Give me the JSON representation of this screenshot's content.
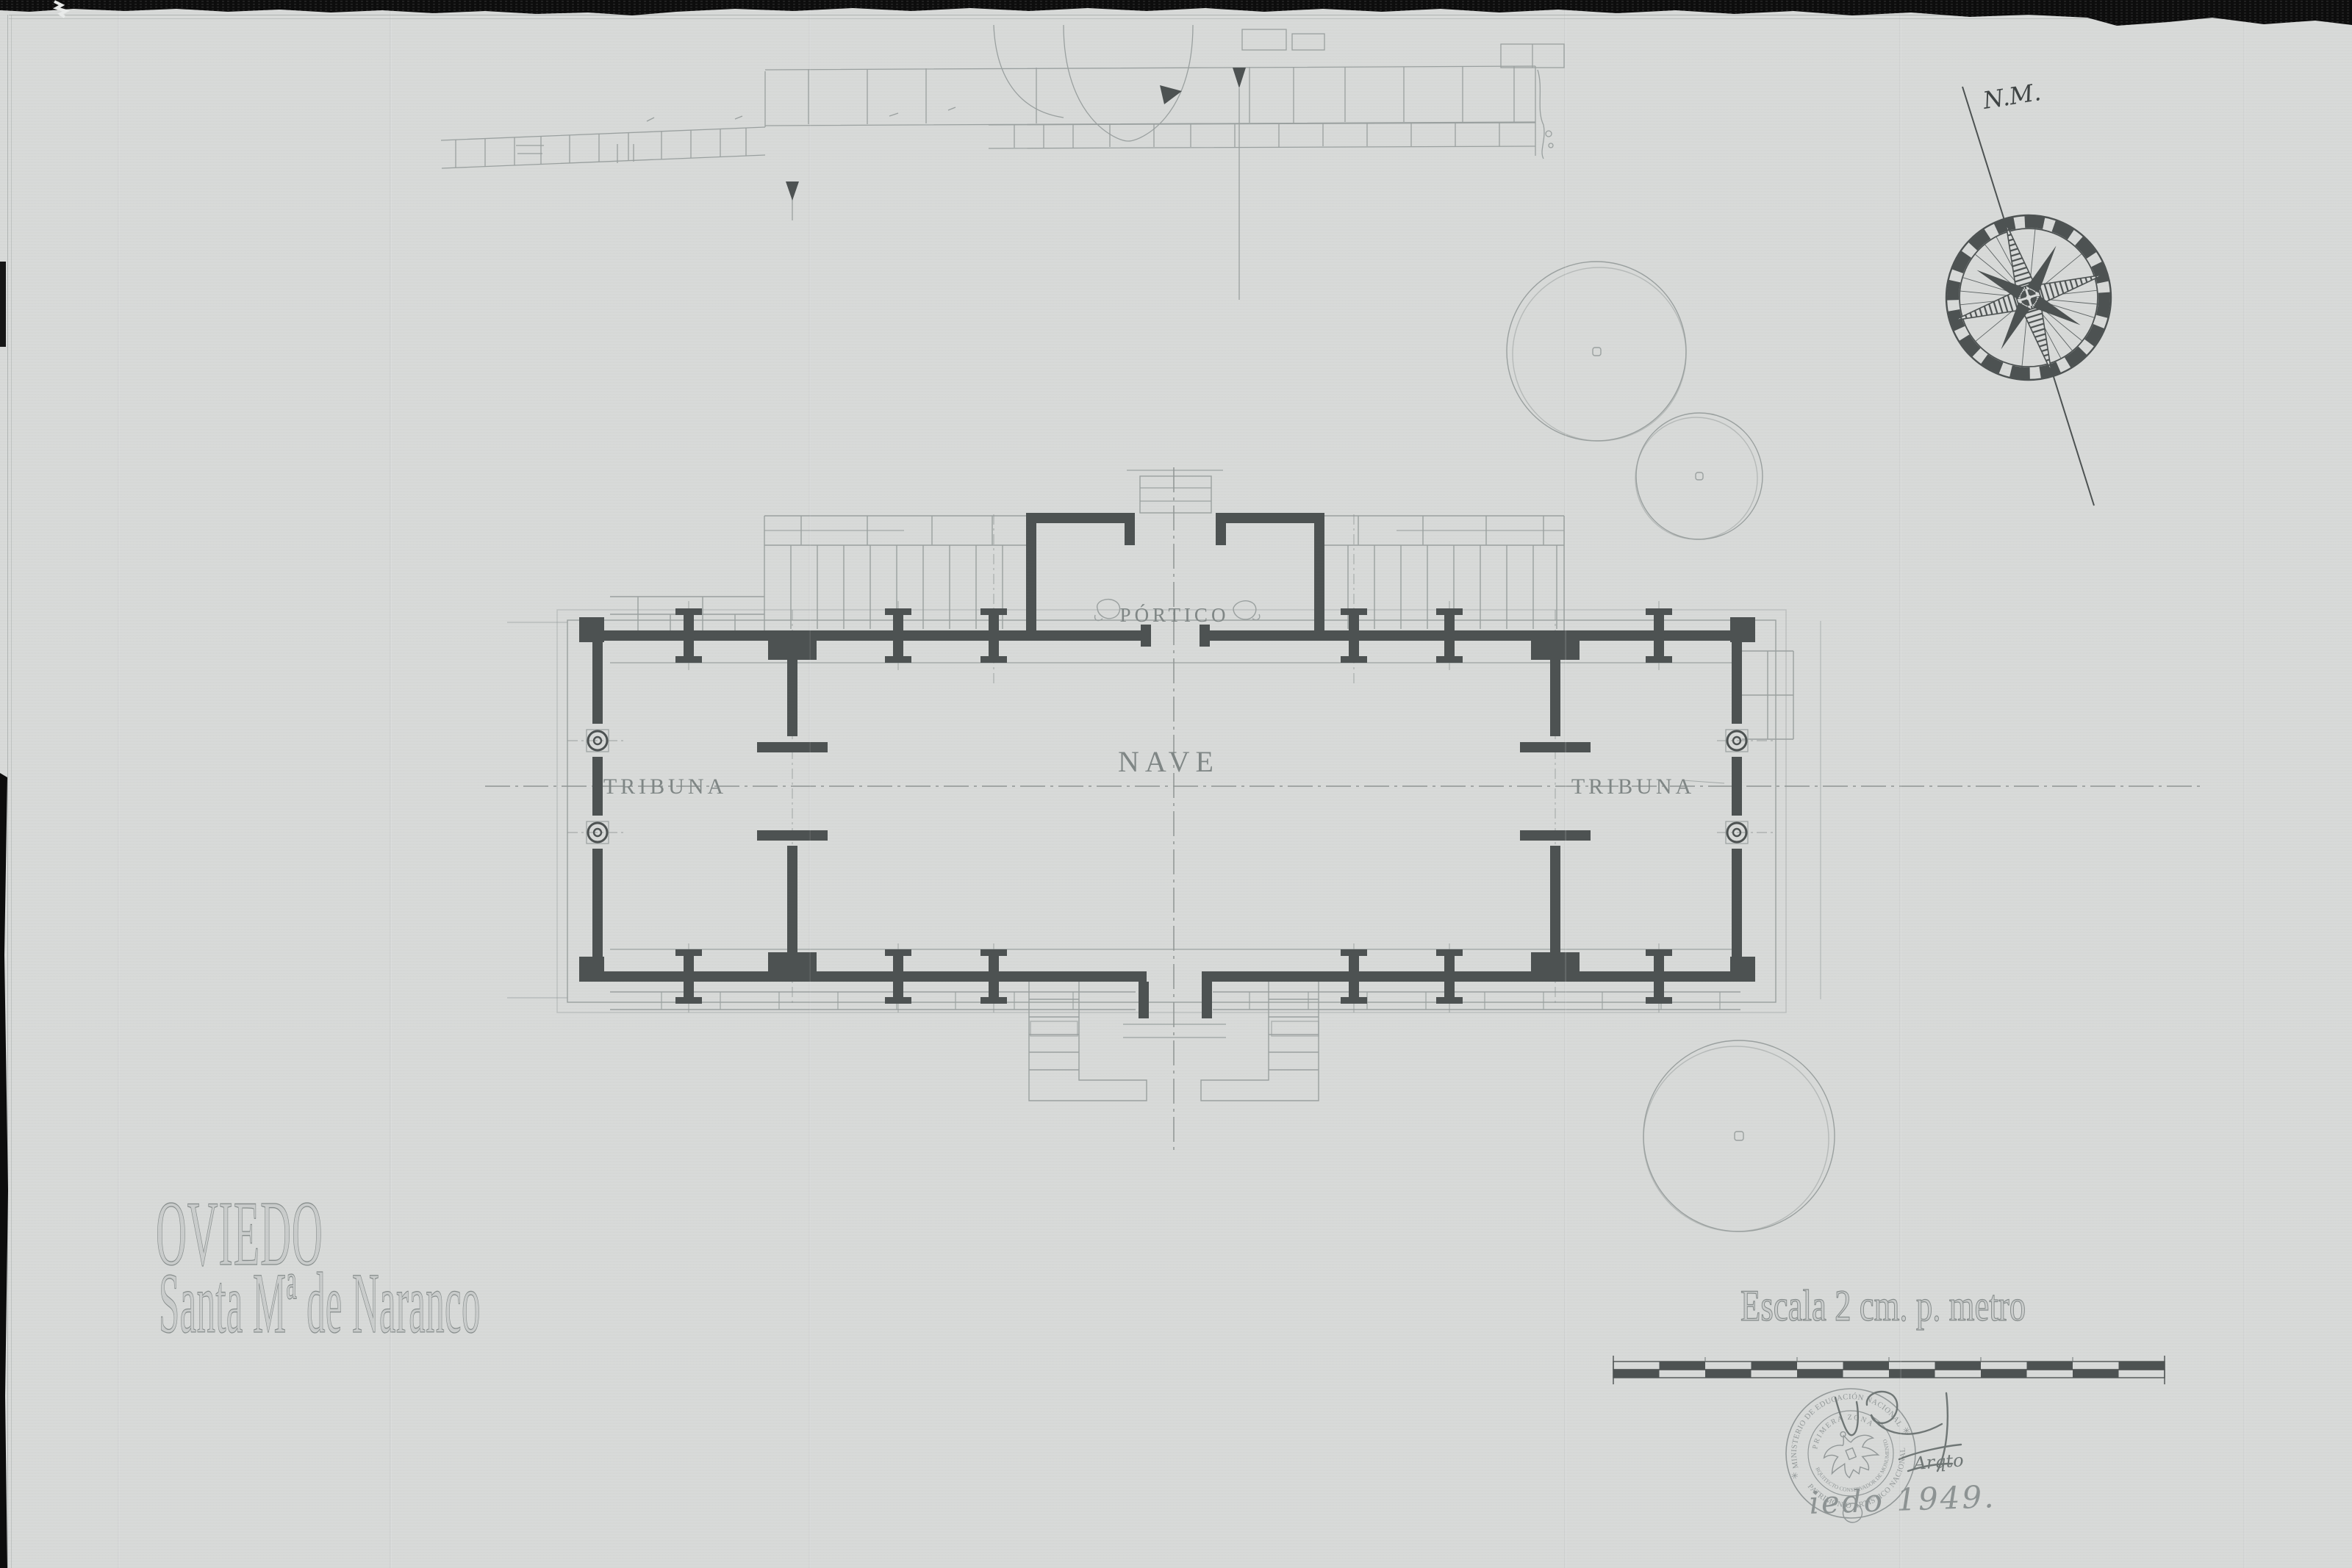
{
  "palette": {
    "paper": "#d8dad9",
    "ink_dark": "#4d5252",
    "ink_mid": "#6f7675",
    "ink_light": "#9aa09f",
    "scan_black": "#0e0e0e"
  },
  "titles": {
    "city": "OVIEDO",
    "monument": "Santa Mª de Naranco"
  },
  "plan": {
    "labels": {
      "portico": "PÓRTICO",
      "nave": "NAVE",
      "tribuna_left": "TRIBUNA",
      "tribuna_right": "TRIBUNA"
    }
  },
  "compass": {
    "label": "N.M."
  },
  "scale_bar": {
    "caption": "Escala 2 cm. p. metro"
  },
  "stamp": {
    "outer_top": "MINISTERIO DE EDUCACIÓN NACIONAL",
    "outer_bottom": "PATRIMONIO ARTISTICO NACIONAL",
    "inner_top": "PRIMERA ZONA",
    "inner_bottom": "ARQUITECTO CONSERVADOR DE MONUMENTOS",
    "separator": "✳"
  },
  "signature": {
    "credential": "Arqto",
    "place_year": "iedo 1949."
  }
}
